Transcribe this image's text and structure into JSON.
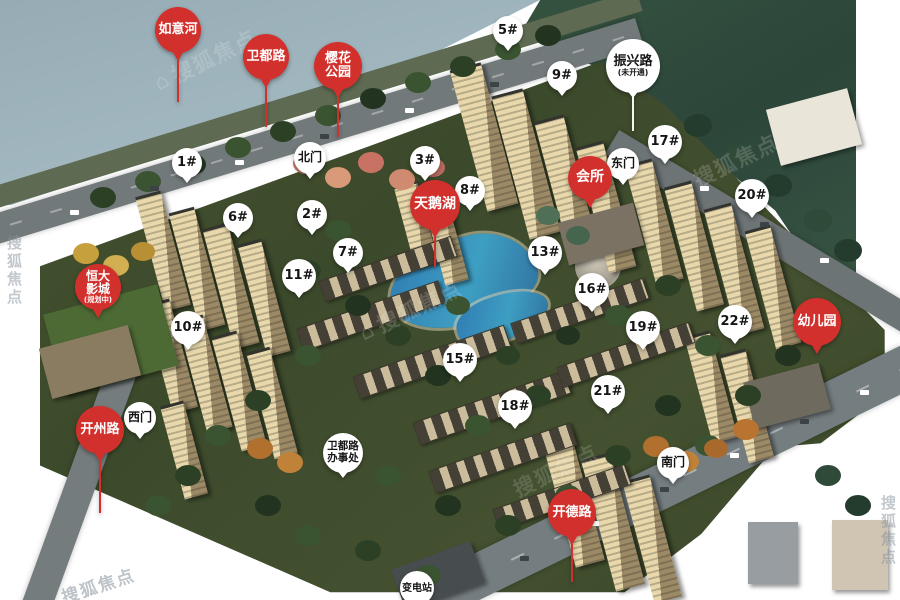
{
  "watermark": {
    "text": "搜狐焦点",
    "house_glyph": "⌂"
  },
  "colors": {
    "red_pin": "#d2302c",
    "white_pin": "#ffffff",
    "pin_text_dark": "#151515",
    "water": "#9bb0b9",
    "lake": "#3a8fbe",
    "site_green": "#41502d"
  },
  "map": {
    "red_pins": [
      {
        "id": "ruyi-river",
        "lines": [
          "如意河"
        ],
        "x": 178,
        "y": 30,
        "w": 46,
        "fs": 13,
        "needle": 42
      },
      {
        "id": "weidu-road",
        "lines": [
          "卫都路"
        ],
        "x": 266,
        "y": 57,
        "w": 46,
        "fs": 13,
        "needle": 40
      },
      {
        "id": "sakura-park",
        "lines": [
          "樱花",
          "公园"
        ],
        "x": 338,
        "y": 66,
        "w": 48,
        "fs": 13,
        "needle": 40
      },
      {
        "id": "swan-lake",
        "lines": [
          "天鹅湖"
        ],
        "x": 435,
        "y": 205,
        "w": 50,
        "fs": 14,
        "needle": 30
      },
      {
        "id": "clubhouse",
        "lines": [
          "会所"
        ],
        "x": 590,
        "y": 178,
        "w": 44,
        "fs": 14,
        "needle": 0
      },
      {
        "id": "hengda-cinema",
        "lines": [
          "恒大",
          "影城",
          "(规划中)"
        ],
        "x": 98,
        "y": 287,
        "w": 46,
        "fs": 12,
        "needle": 0
      },
      {
        "id": "kaizhou-road",
        "lines": [
          "开州路"
        ],
        "x": 100,
        "y": 430,
        "w": 48,
        "fs": 13,
        "needle": 52
      },
      {
        "id": "kaide-road",
        "lines": [
          "开德路"
        ],
        "x": 572,
        "y": 513,
        "w": 48,
        "fs": 13,
        "needle": 38
      },
      {
        "id": "kindergarten",
        "lines": [
          "幼儿园"
        ],
        "x": 817,
        "y": 322,
        "w": 48,
        "fs": 13,
        "needle": 0
      }
    ],
    "white_pins": [
      {
        "id": "building-1",
        "lines": [
          "1#"
        ],
        "x": 187,
        "y": 163,
        "w": 30,
        "fs": 13,
        "needle": 0
      },
      {
        "id": "building-2",
        "lines": [
          "2#"
        ],
        "x": 312,
        "y": 215,
        "w": 30,
        "fs": 13,
        "needle": 0
      },
      {
        "id": "building-3",
        "lines": [
          "3#"
        ],
        "x": 425,
        "y": 161,
        "w": 30,
        "fs": 13,
        "needle": 0
      },
      {
        "id": "building-5",
        "lines": [
          "5#"
        ],
        "x": 508,
        "y": 31,
        "w": 30,
        "fs": 13,
        "needle": 0
      },
      {
        "id": "building-6",
        "lines": [
          "6#"
        ],
        "x": 238,
        "y": 218,
        "w": 30,
        "fs": 13,
        "needle": 0
      },
      {
        "id": "building-7",
        "lines": [
          "7#"
        ],
        "x": 348,
        "y": 253,
        "w": 30,
        "fs": 13,
        "needle": 0
      },
      {
        "id": "building-8",
        "lines": [
          "8#"
        ],
        "x": 470,
        "y": 191,
        "w": 30,
        "fs": 13,
        "needle": 0
      },
      {
        "id": "building-9",
        "lines": [
          "9#"
        ],
        "x": 562,
        "y": 76,
        "w": 30,
        "fs": 13,
        "needle": 0
      },
      {
        "id": "building-10",
        "lines": [
          "10#"
        ],
        "x": 188,
        "y": 328,
        "w": 34,
        "fs": 13,
        "needle": 0
      },
      {
        "id": "building-11",
        "lines": [
          "11#"
        ],
        "x": 299,
        "y": 276,
        "w": 34,
        "fs": 13,
        "needle": 0
      },
      {
        "id": "building-13",
        "lines": [
          "13#"
        ],
        "x": 545,
        "y": 253,
        "w": 34,
        "fs": 13,
        "needle": 0
      },
      {
        "id": "building-15",
        "lines": [
          "15#"
        ],
        "x": 460,
        "y": 360,
        "w": 34,
        "fs": 13,
        "needle": 0
      },
      {
        "id": "building-16",
        "lines": [
          "16#"
        ],
        "x": 592,
        "y": 290,
        "w": 34,
        "fs": 13,
        "needle": 0
      },
      {
        "id": "building-17",
        "lines": [
          "17#"
        ],
        "x": 665,
        "y": 142,
        "w": 34,
        "fs": 13,
        "needle": 0
      },
      {
        "id": "building-18",
        "lines": [
          "18#"
        ],
        "x": 515,
        "y": 407,
        "w": 34,
        "fs": 13,
        "needle": 0
      },
      {
        "id": "building-19",
        "lines": [
          "19#"
        ],
        "x": 643,
        "y": 328,
        "w": 34,
        "fs": 13,
        "needle": 0
      },
      {
        "id": "building-20",
        "lines": [
          "20#"
        ],
        "x": 752,
        "y": 196,
        "w": 34,
        "fs": 13,
        "needle": 0
      },
      {
        "id": "building-21",
        "lines": [
          "21#"
        ],
        "x": 608,
        "y": 392,
        "w": 34,
        "fs": 13,
        "needle": 0
      },
      {
        "id": "building-22",
        "lines": [
          "22#"
        ],
        "x": 735,
        "y": 322,
        "w": 34,
        "fs": 13,
        "needle": 0
      },
      {
        "id": "north-gate",
        "lines": [
          "北门"
        ],
        "x": 310,
        "y": 158,
        "w": 32,
        "fs": 12,
        "needle": 0
      },
      {
        "id": "east-gate",
        "lines": [
          "东门"
        ],
        "x": 623,
        "y": 164,
        "w": 32,
        "fs": 12,
        "needle": 0
      },
      {
        "id": "west-gate",
        "lines": [
          "西门"
        ],
        "x": 140,
        "y": 418,
        "w": 32,
        "fs": 12,
        "needle": 0
      },
      {
        "id": "south-gate",
        "lines": [
          "南门"
        ],
        "x": 673,
        "y": 463,
        "w": 32,
        "fs": 12,
        "needle": 0
      },
      {
        "id": "zhenxing-road",
        "lines": [
          "振兴路",
          "(未开通)"
        ],
        "x": 633,
        "y": 66,
        "w": 54,
        "fs": 13,
        "needle": 34
      },
      {
        "id": "weidu-road-office",
        "lines": [
          "卫都路",
          "办事处"
        ],
        "x": 343,
        "y": 453,
        "w": 40,
        "fs": 10.5,
        "needle": 0
      },
      {
        "id": "substation",
        "lines": [
          "变电站"
        ],
        "x": 417,
        "y": 588,
        "w": 34,
        "fs": 10,
        "needle": 0
      }
    ]
  }
}
